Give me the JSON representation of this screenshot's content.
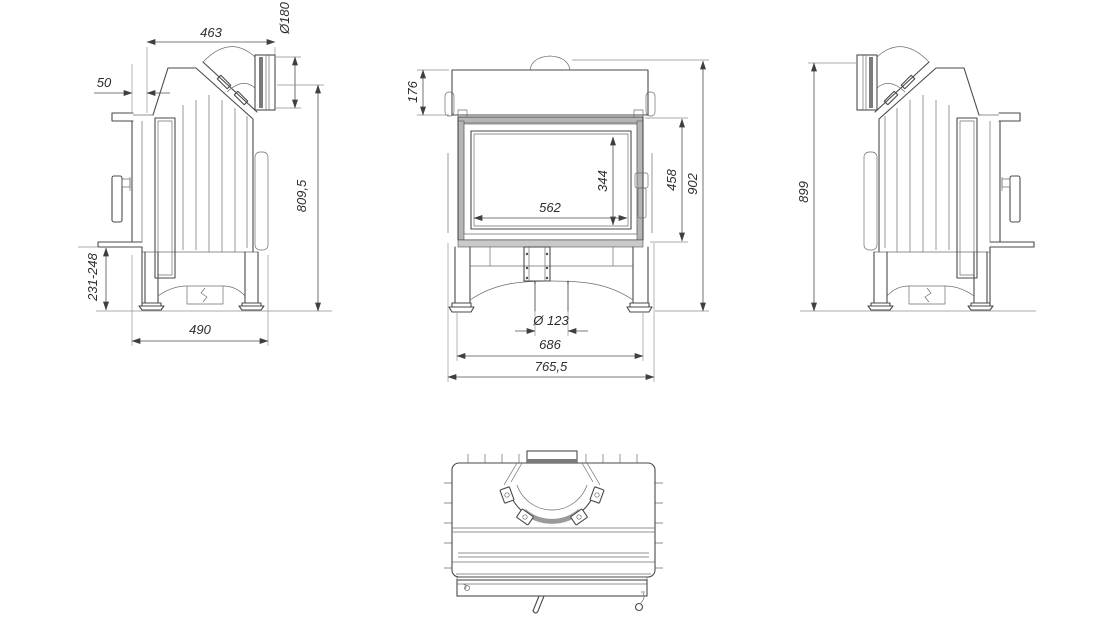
{
  "drawing": {
    "views": {
      "left": {
        "dims": {
          "top_width": "463",
          "flue_diameter": "Ø180",
          "front_offset": "50",
          "flue_axis_height": "809,5",
          "plinth_height": "231-248",
          "depth": "490"
        }
      },
      "front": {
        "dims": {
          "hood_height": "176",
          "glass_height": "344",
          "glass_width": "562",
          "door_height": "458",
          "total_height": "902",
          "air_inlet_diameter": "Ø 123",
          "feet_span": "686",
          "total_width": "765,5"
        }
      },
      "right": {
        "dims": {
          "flue_top_height": "899"
        }
      }
    }
  }
}
